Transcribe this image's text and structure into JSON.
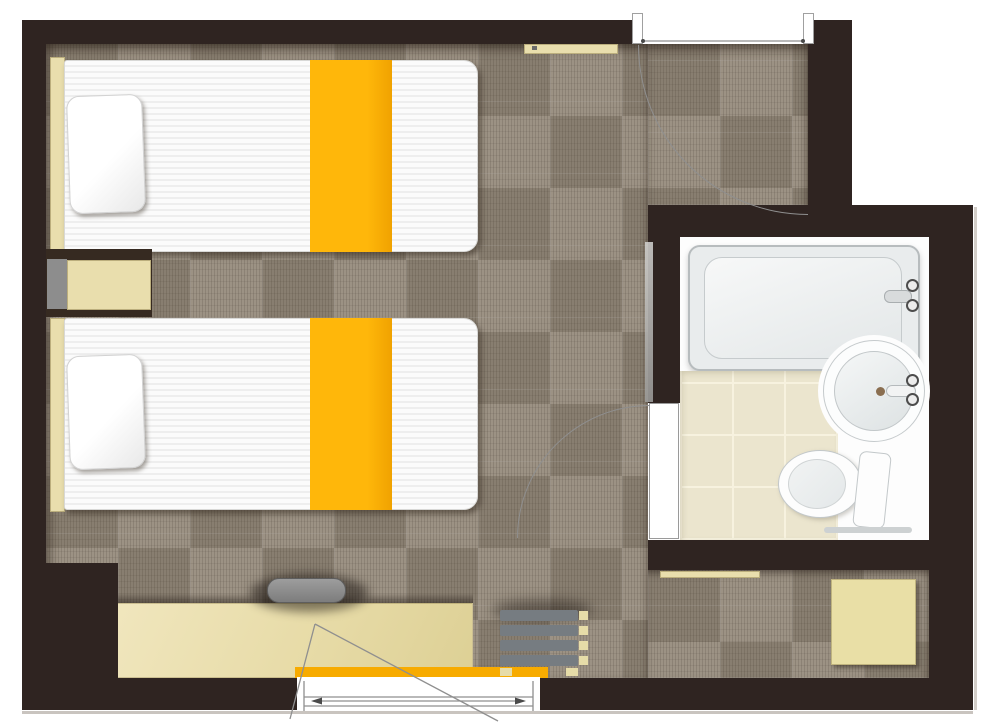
{
  "title": "Hotel twin room floor plan (top-down architectural view)",
  "palette": {
    "wall": "#2f2421",
    "carpet": "#94897a",
    "furniture_cream": "#e9dead",
    "accent_yellow": "#f7ab00",
    "bed_white": "#fafafa",
    "fixture_gray": "#8e8e8e",
    "slat_gray": "#767c81",
    "tile_cream": "#ebe5ce",
    "bath_white": "#fdfdfd",
    "line_gray": "#8f8f8f"
  },
  "bedroom": {
    "beds": [
      {
        "name": "twin-bed-1",
        "pillow": "white pillow",
        "runner": "yellow bed runner"
      },
      {
        "name": "twin-bed-2",
        "pillow": "white pillow",
        "runner": "yellow bed runner"
      }
    ],
    "furniture": [
      "headboard strip per bed",
      "nightstand between beds with gray panel",
      "wall shelf near entrance",
      "long desk/counter along bottom wall",
      "desk chair (gray)",
      "yellow bench strip at window",
      "slatted luggage rack",
      "cream stool in rear alcove",
      "threshold strip below bathroom"
    ],
    "openings": [
      "entrance door at top with quarter-circle swing arc",
      "window in bottom wall with frame lines, arrows and swing triangle"
    ]
  },
  "bathroom": {
    "fixtures": [
      "bathtub with faucet and two handles",
      "round washbasin with faucet, two handles and drain",
      "toilet with tank and rail"
    ],
    "floor": "cream ceramic tile grid",
    "door": "hinged door on left wall with quarter-circle swing arc",
    "extras": [
      "mirror strip on corridor side"
    ]
  }
}
